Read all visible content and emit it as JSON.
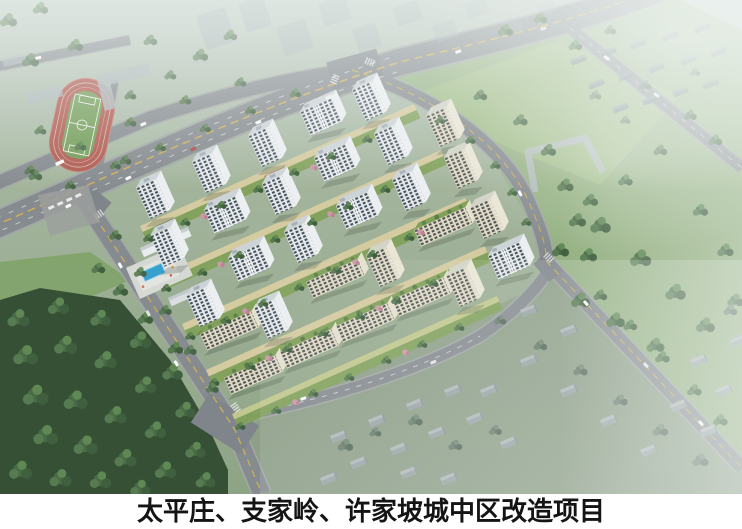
{
  "caption": {
    "text": "太平庄、支家岭、许家坡城中区改造项目"
  },
  "scene": {
    "description": "Aerial bird's-eye architectural rendering of an urban-village redevelopment residential project",
    "elements": [
      "running-track-stadium",
      "soccer-field",
      "main-boulevard",
      "cross-road",
      "residential-complex",
      "white-apartment-towers",
      "cream-green-roof-slabs",
      "courtyard-promenades",
      "swimming-pool-plaza",
      "southwest-forest",
      "east-park",
      "village-houses-southeast",
      "village-houses-northeast",
      "hazy-city-blocks",
      "cars",
      "caption-bar"
    ],
    "colors": {
      "caption_bg": "#ffffff",
      "caption_text": "#141414",
      "ground_top": "#bcc8bf",
      "ground_mid": "#a3b49a",
      "ground_bottom": "#8da383",
      "park_lawn": "#93b27d",
      "lawn_bright": "#a5c287",
      "forest_dark": "#2f4a2e",
      "tree_green": "#44663f",
      "road_asphalt": "#84898e",
      "road_casing": "#a2a7a4",
      "lane_yellow": "#d9b44a",
      "lane_white": "#eceff0",
      "track_red": "#b2574c",
      "field_green": "#719c54",
      "tower_facade": "#eceff2",
      "tower_window": "#3f4b55",
      "tower_roof": "#d0d6da",
      "slab_facade": "#e7dec6",
      "green_roof": "#7fa055",
      "promenade": "#d8cda0",
      "blossom_pink": "#d097a6",
      "pool_blue": "#2f9fd0",
      "plaza_grey": "#d9dad5",
      "village_house": "#9aa3a5",
      "shadow": "#1e2a1e",
      "haze_white": "#f2f7f5"
    }
  }
}
